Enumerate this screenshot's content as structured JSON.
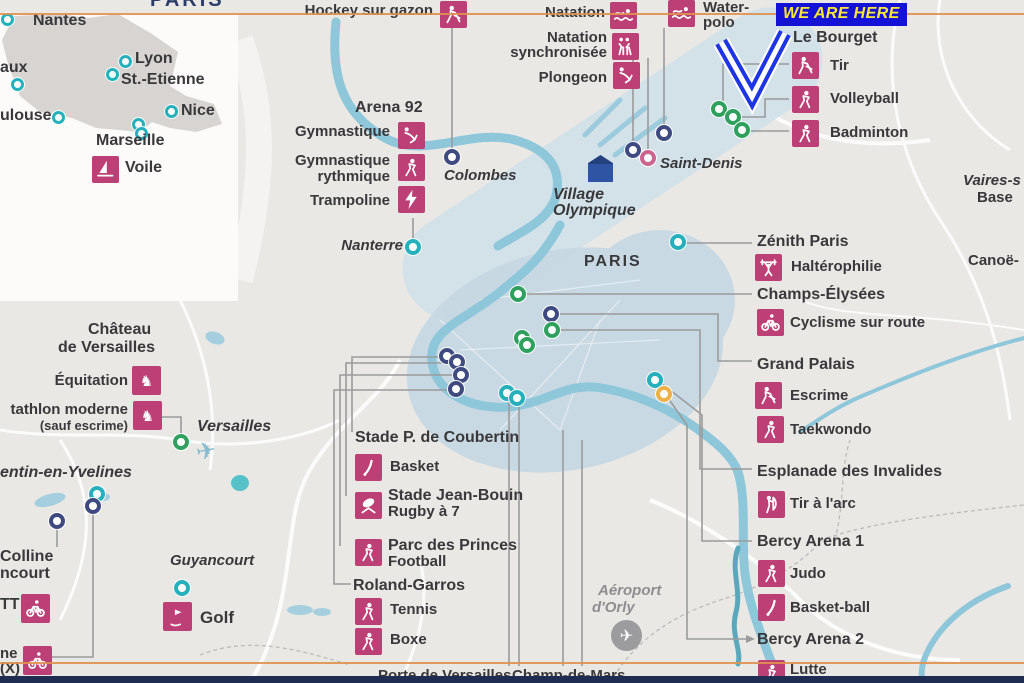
{
  "banner": {
    "text": "WE ARE HERE"
  },
  "inset": {
    "title_fragment": "PARIS",
    "nantes": "Nantes",
    "bordeaux_fragment": "aux",
    "lyon": "Lyon",
    "st_etienne": "St.-Etienne",
    "nice": "Nice",
    "toulouse_fragment": "ulouse",
    "marseille": "Marseille",
    "voile": "Voile"
  },
  "cluster_north": {
    "hockey": "Hockey sur gazon",
    "natation": "Natation",
    "natation_sync_line1": "Natation",
    "natation_sync_line2": "synchronisée",
    "plongeon": "Plongeon",
    "water_polo_line1": "Water-",
    "water_polo_line2": "polo",
    "le_bourget": "Le Bourget",
    "tir": "Tir",
    "volleyball": "Volleyball",
    "badminton": "Badminton",
    "saint_denis": "Saint-Denis",
    "village_line1": "Village",
    "village_line2": "Olympique"
  },
  "cluster_west": {
    "arena92": "Arena 92",
    "gymnastique": "Gymnastique",
    "gym_rythmique_line1": "Gymnastique",
    "gym_rythmique_line2": "rythmique",
    "trampoline": "Trampoline",
    "colombes": "Colombes",
    "nanterre": "Nanterre"
  },
  "paris_area": {
    "paris": "PARIS"
  },
  "right_column": {
    "zenith": "Zénith Paris",
    "halterophilie": "Haltérophilie",
    "champs_elysees": "Champs-Élysées",
    "cyclisme_route": "Cyclisme sur route",
    "grand_palais": "Grand Palais",
    "escrime": "Escrime",
    "taekwondo": "Taekwondo",
    "invalides": "Esplanade des Invalides",
    "tir_arc": "Tir à l'arc",
    "bercy1": "Bercy Arena 1",
    "judo": "Judo",
    "basketball": "Basket-ball",
    "bercy2": "Bercy Arena 2",
    "lutte": "Lutte",
    "vaires_fragment": "Vaires-s",
    "base_fragment": "Base",
    "canoe_fragment": "Canoë-"
  },
  "left_column": {
    "chateau_line1": "Château",
    "chateau_line2": "de Versailles",
    "equitation": "Équitation",
    "pentathlon_fragment": "tathlon moderne",
    "pentathlon_sub": "(sauf escrime)",
    "versailles": "Versailles",
    "yvelines_fragment": "entin-en-Yvelines",
    "colline_line1": "Colline",
    "colline_line2": "ncourt",
    "vtt_fragment": "TT",
    "bmx_fragment_line1": "ne",
    "bmx_fragment_line2": "(X)",
    "guyancourt": "Guyancourt",
    "golf": "Golf"
  },
  "bottom_center": {
    "coubertin": "Stade P. de Coubertin",
    "basket": "Basket",
    "jean_bouin": "Stade Jean-Bouin",
    "rugby7": "Rugby à 7",
    "parc_princes": "Parc des Princes",
    "football": "Football",
    "roland_garros": "Roland-Garros",
    "tennis": "Tennis",
    "boxe": "Boxe",
    "aeroport_line1": "Aéroport",
    "aeroport_line2": "d'Orly",
    "porte_versailles_fragment": "Porte de Versailles",
    "champ_mars_fragment": "Champ-de-Mars"
  },
  "icons": {
    "plane_glyph": "✈"
  },
  "colors": {
    "icon_pink": "#bc4076",
    "marker_navy": "#3f4b80",
    "marker_teal": "#25b0bc",
    "marker_green": "#2fa05e",
    "marker_pink": "#cc6490",
    "marker_yellow": "#edb14a",
    "river_blue": "#8ec6da",
    "zone_blue": "#c9dbe6",
    "banner_bg": "#1512d8",
    "banner_text": "#ffe835",
    "arrow_blue": "#1d35e3",
    "orange_line": "#e0914e",
    "bottom_bar_navy": "#1f2d52",
    "village_house": "#2d4f9e"
  }
}
